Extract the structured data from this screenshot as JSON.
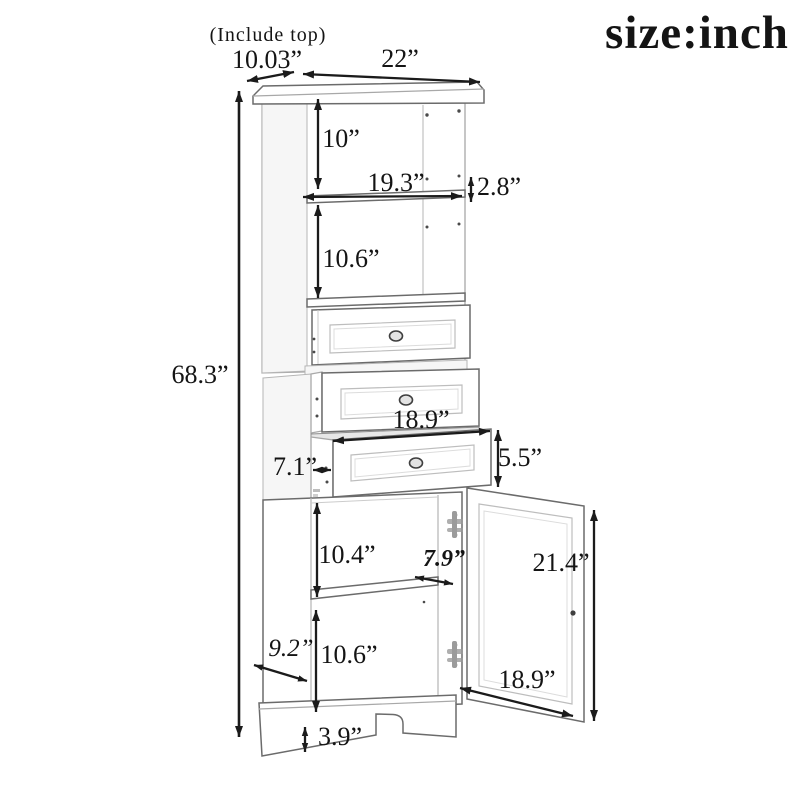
{
  "page": {
    "note": "(Include top)",
    "size_label": "size:inch"
  },
  "dims": {
    "top_depth": "10.03”",
    "top_width": "22”",
    "total_height": "68.3”",
    "open_top_height": "10”",
    "inner_width": "19.3”",
    "shelf_gap": "2.8”",
    "open_mid_height": "10.6”",
    "drawer_width": "18.9”",
    "drawer_depth": "7.1”",
    "drawer_height": "5.5”",
    "lower_open_height": "10.4”",
    "shelf_depth": "7.9”",
    "door_height": "21.4”",
    "bottom_open_height": "10.6”",
    "base_depth": "9.2”",
    "door_width": "18.9”",
    "base_height": "3.9”"
  },
  "colors": {
    "ink": "#1b1b1b",
    "edge": "#a8a8a8",
    "edge_dark": "#666666",
    "background": "#ffffff"
  }
}
